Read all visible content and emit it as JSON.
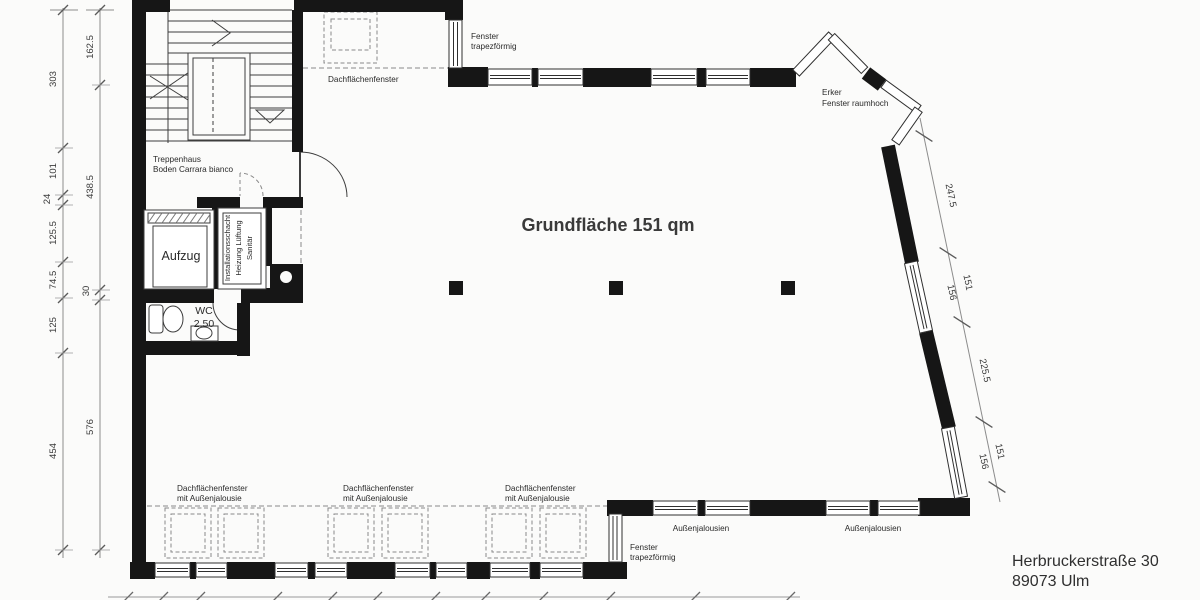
{
  "title_block": {
    "address_line1": "Herbruckerstraße 30",
    "address_line2": "89073 Ulm"
  },
  "main_area": {
    "label": "Grundfläche 151 qm"
  },
  "rooms": {
    "staircase": {
      "line1": "Treppenhaus",
      "line2": "Boden Carrara bianco"
    },
    "elevator": {
      "label": "Aufzug"
    },
    "shaft": {
      "line1": "Installationsschacht",
      "line2": "Heizung Lüftung",
      "line3": "Sanitär"
    },
    "wc": {
      "label": "WC",
      "height": "2.50"
    }
  },
  "features": {
    "window_trapezoid_line1": "Fenster",
    "window_trapezoid_line2": "trapezförmig",
    "roof_window": "Dachflächenfenster",
    "bay_line1": "Erker",
    "bay_line2": "Fenster raumhoch",
    "shutters": "Außenjalousien",
    "roof_window_shutter_line1": "Dachflächenfenster",
    "roof_window_shutter_line2": "mit Außenjalousie"
  },
  "dimensions": {
    "left_outer": [
      "303",
      "101",
      "24",
      "125.5",
      "74.5",
      "125",
      "454"
    ],
    "left_inner": [
      "162.5",
      "438.5",
      "30",
      "576"
    ],
    "right": [
      "247.5",
      "151",
      "156",
      "225.5",
      "151",
      "156"
    ]
  },
  "colors": {
    "wall": "#161616",
    "thin_line": "#3d3d3d",
    "dimension_line": "#8c8c8c",
    "background": "#fbfbfa",
    "text": "#2a2a2a"
  }
}
